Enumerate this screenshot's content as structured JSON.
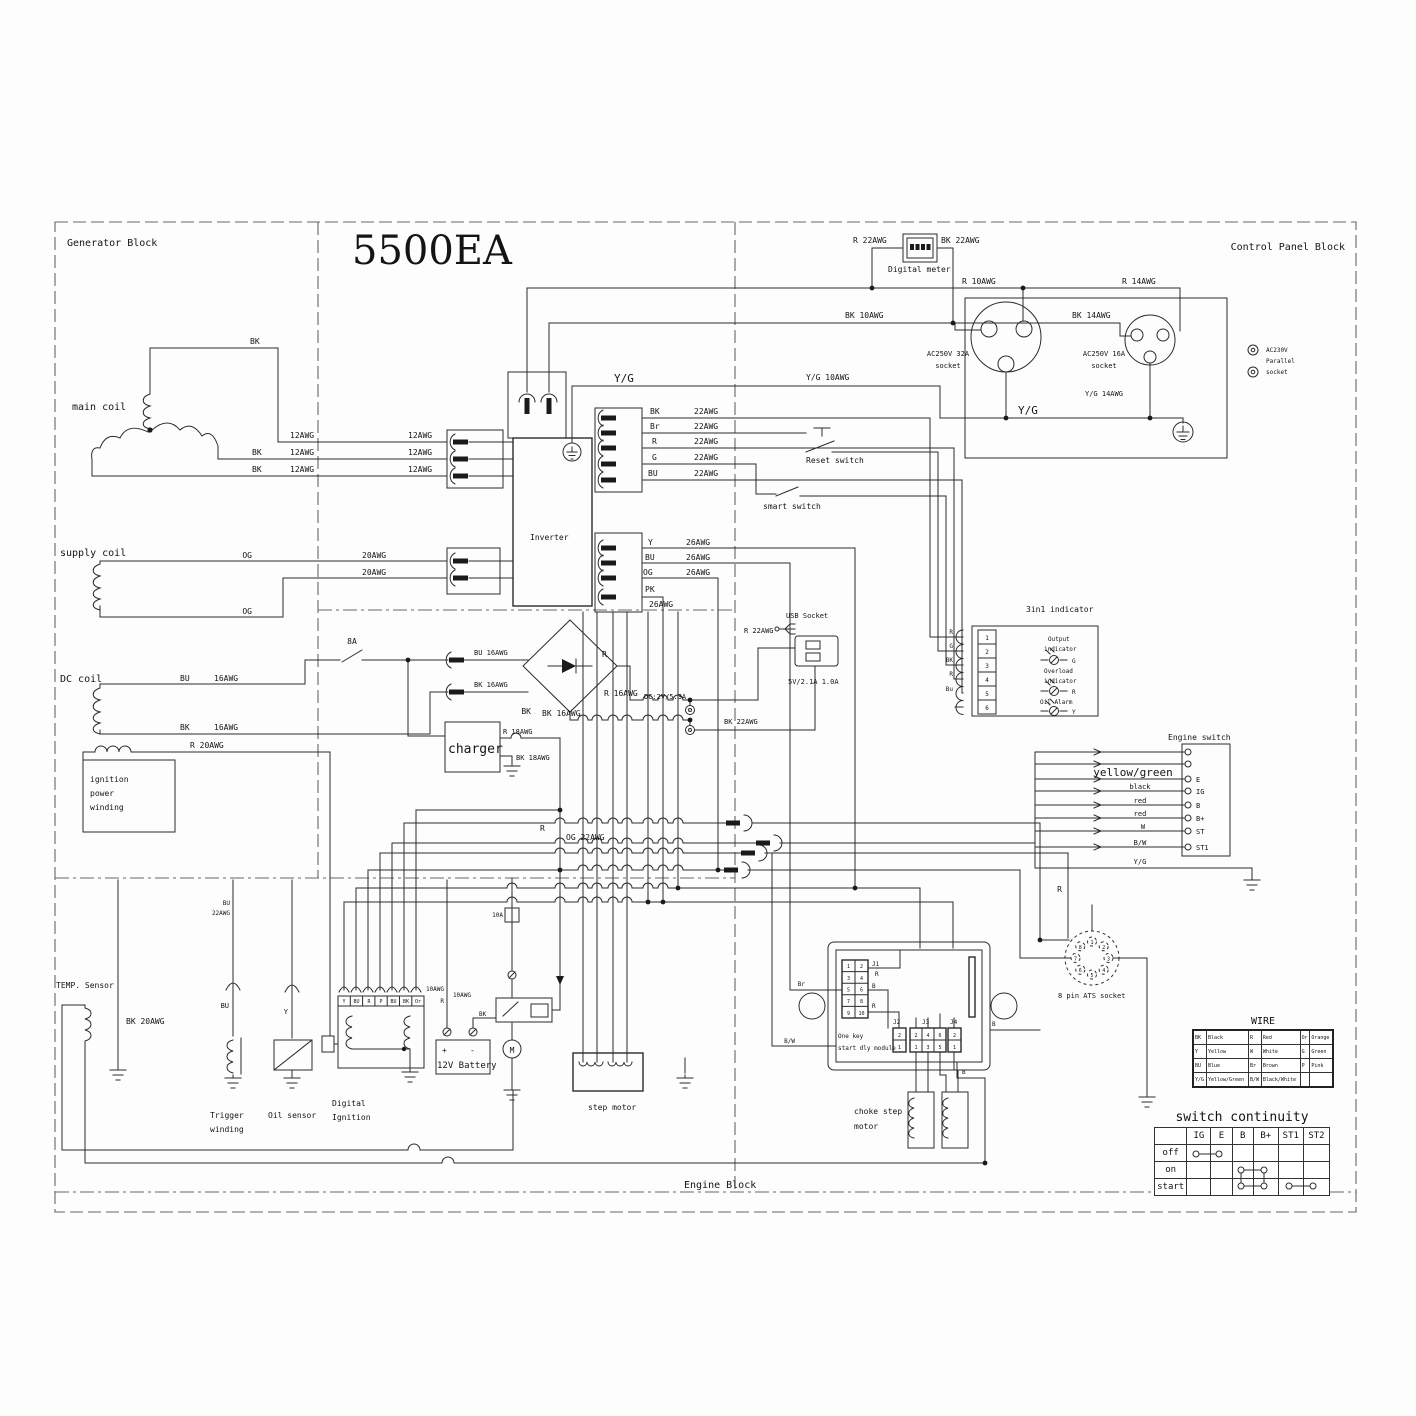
{
  "L": {
    "generator_block": "Generator Block",
    "control_panel_block": "Control Panel Block",
    "engine_block": "Engine Block",
    "title": "5500EA",
    "main_coil": "main coil",
    "supply_coil": "supply coil",
    "dc_coil": "DC coil",
    "ign1": "ignition",
    "ign2": "power",
    "ign3": "winding",
    "temp": "TEMP. Sensor",
    "trig1": "Trigger",
    "trig2": "winding",
    "oil": "Oil sensor",
    "dig1": "Digital",
    "dig2": "Ignition",
    "battery": "12V Battery",
    "plus": "+",
    "minus": "-",
    "m": "M",
    "step": "step motor",
    "choke1": "choke step",
    "choke2": "motor",
    "okm1": "One key",
    "okm2": "start dly module",
    "ats": "8 pin ATS socket",
    "inverter": "Inverter",
    "charger": "charger",
    "meter": "Digital meter",
    "usb": "USB Socket",
    "usb_spec": "5V/2.1A 1.0A",
    "dc_spec": "DC:2V/5.3A",
    "reset": "Reset switch",
    "smart": "smart switch",
    "ind": "3in1 indicator",
    "out1": "Output",
    "out2": "indicator",
    "ovl1": "Overload",
    "ovl2": "indicator",
    "oil_alarm": "Oil Alarm",
    "esw": "Engine switch",
    "s32": "AC250V 32A",
    "s16": "AC250V 16A",
    "sock": "socket",
    "par1": "AC230V",
    "par2": "Parallel",
    "f8": "8A",
    "f10": "10A",
    "yg": "Y/G",
    "yg10": "Y/G 10AWG",
    "yg14": "Y/G 14AWG",
    "r10": "R 10AWG",
    "bk10": "BK 10AWG",
    "r14": "R 14AWG",
    "bk14": "BK 14AWG",
    "r22": "R 22AWG",
    "bk22": "BK 22AWG",
    "og22": "OG 22AWG",
    "r16": "R 16AWG",
    "bk16": "BK 16AWG",
    "bu16": "BU 16AWG",
    "r18": "R 18AWG",
    "bk18": "BK 18AWG",
    "r20": "R 20AWG",
    "bk20": "BK 20AWG",
    "awg12": "12AWG",
    "awg16": "16AWG",
    "awg20": "20AWG",
    "awg22": "22AWG",
    "awg26": "26AWG",
    "awg10": "10AWG",
    "bk": "BK",
    "bu": "BU",
    "og": "OG",
    "pk": "PK",
    "y": "Y",
    "r": "R",
    "g": "G",
    "b": "B",
    "br": "Br",
    "or": "Or",
    "p": "P",
    "w": "W",
    "bw": "B/W",
    "yel_grn": "yellow/green",
    "black": "black",
    "red": "red",
    "j1": "J1",
    "j2": "J2",
    "j3": "J3",
    "j4": "J4"
  },
  "ind_pins": [
    "1",
    "2",
    "3",
    "4",
    "5",
    "6"
  ],
  "ind_wires": [
    "R",
    "G",
    "BK",
    "R",
    "Bu"
  ],
  "es_terms": [
    "E",
    "IG",
    "B",
    "B+",
    "ST",
    "ST1"
  ],
  "di_pins": [
    "Y",
    "BU",
    "R",
    "P",
    "BU",
    "BK",
    "Or"
  ],
  "j1_pins": [
    "1",
    "2",
    "3",
    "4",
    "5",
    "6",
    "7",
    "8",
    "9",
    "10"
  ],
  "j2_pins": [
    "2",
    "1"
  ],
  "j3_top": [
    "2",
    "4",
    "6"
  ],
  "j3_bot": [
    "1",
    "3",
    "5"
  ],
  "j4_pins": [
    "2",
    "1"
  ],
  "ats_pins": [
    "1",
    "2",
    "3",
    "4",
    "5",
    "6",
    "7",
    "8"
  ],
  "wire_table": {
    "title": "WIRE",
    "rows": [
      [
        "BK",
        "Black",
        "R",
        "Red",
        "Or",
        "Orange"
      ],
      [
        "Y",
        "Yellow",
        "W",
        "White",
        "G",
        "Green"
      ],
      [
        "BU",
        "Blue",
        "Br",
        "Brown",
        "P",
        "Pink"
      ],
      [
        "Y/G",
        "Yellow/Green",
        "B/W",
        "Black/White",
        "",
        ""
      ]
    ]
  },
  "continuity": {
    "title": "switch continuity",
    "cols": [
      "IG",
      "E",
      "B",
      "B+",
      "ST1",
      "ST2"
    ],
    "rows": [
      "off",
      "on",
      "start"
    ]
  }
}
